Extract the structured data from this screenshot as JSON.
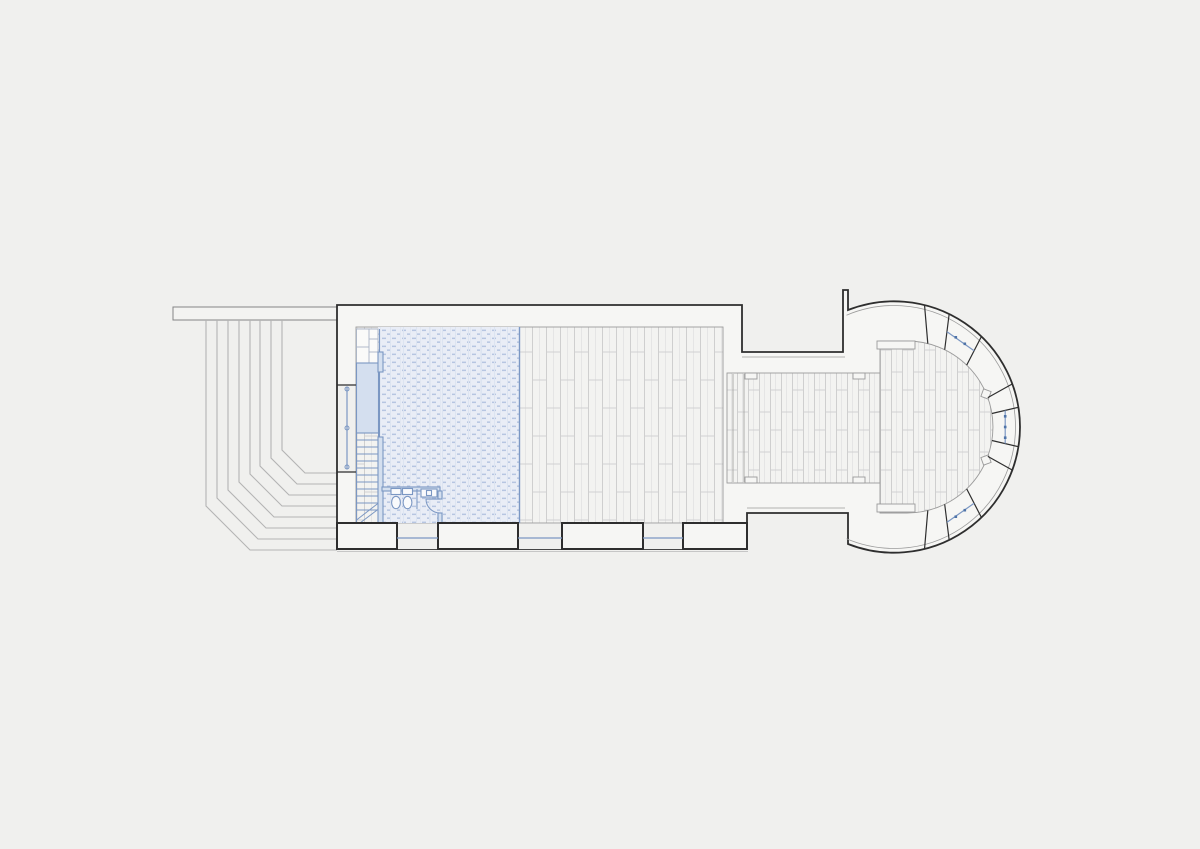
{
  "document": {
    "type": "architectural floor plan",
    "subject": "chapel ground-floor plan with entrance steps, nave, stair and WC block, chancel passage and semicircular apse",
    "visible_text": "",
    "orientation": "entrance on the left (west), apse on the right (east)"
  },
  "colors": {
    "background": "#f0f0ee",
    "wall_fill": "#f6f6f4",
    "wall_line": "#2e2e2e",
    "wall_line_light": "#858585",
    "inner_line": "#9b9b9b",
    "step_line": "#b4b4b4",
    "floor_fill": "#f3f3f1",
    "plank_line": "#e2e2e2",
    "plank_line_strong": "#cfcfcf",
    "blue_line": "#7b97c3",
    "blue_dark": "#4f74a8",
    "blue_fill": "#e9edf6",
    "blue_dash": "#b6c5e1",
    "blue_soft": "#d4dfef",
    "ground_line": "#c6c6c6"
  },
  "plan": {
    "entrance_steps": {
      "count": 8,
      "location": "outside west entrance, fanning around south-west corner"
    },
    "terrace_wall": {
      "location": "north-west, horizontal band"
    },
    "entrance_door": {
      "type": "double leaf",
      "hinge_points": 3,
      "location": "west wall"
    },
    "gallery_floor": {
      "hatch": "fine blue tile stipple",
      "location": "west bay of nave"
    },
    "stair": {
      "treads": 12,
      "location": "along west wall",
      "direction_break_lines": 2
    },
    "wc_room": {
      "toilets": 2,
      "washbasin": 1,
      "partition": 1,
      "door_swing": "quarter arc"
    },
    "nave": {
      "floor": "vertical plank boards",
      "south_windows": 3,
      "south_piers": 4
    },
    "chancel": {
      "floor": "vertical plank boards",
      "arch_lines": 2,
      "corner_pilasters": 4
    },
    "apse": {
      "shape": "semicircular",
      "windows": 3,
      "window_positions": [
        "north-east",
        "east",
        "south-east"
      ],
      "buttress": "north, thin projection",
      "pilasters": 4
    }
  }
}
